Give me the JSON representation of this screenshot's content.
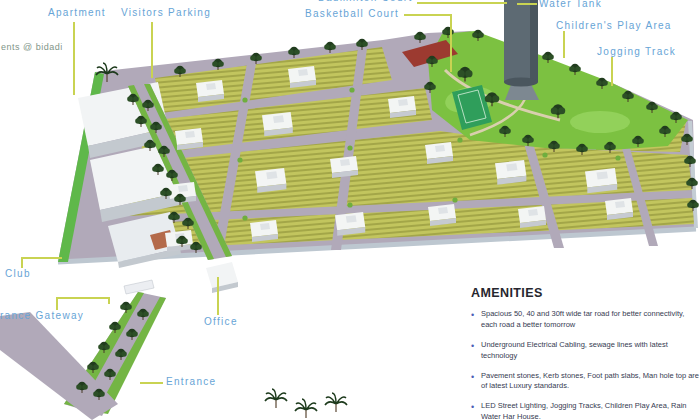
{
  "brand": {
    "text": "ents @ bidadi"
  },
  "map_labels": {
    "apartment": "Apartment",
    "visitors_parking": "Visitors Parking",
    "badminton_court": "Badminton Court",
    "basketball_court": "Basketball Court",
    "water_tank": "Water Tank",
    "childrens_play_area": "Children's Play Area",
    "jogging_track": "Jogging Track",
    "club": "Club",
    "entrance_gateway": "Entrance Gateway",
    "office": "Office",
    "entrance": "Entrance"
  },
  "amenities": {
    "title": "AMENITIES",
    "items": [
      "Spacious 50, 40 and 30ft wide tar road for better connectivity, each road a better tomorrow",
      "Underground Electrical Cabling, sewage lines with latest technology",
      "Pavement stones, Kerb stones, Foot path slabs,  Man hole top are of latest Luxury standards.",
      "LED Street Lighting, Jogging Tracks, Children Play Area, Rain Water Har House."
    ]
  },
  "colors": {
    "label_blue": "#67a4d6",
    "leader_yellow": "#c9d352",
    "plot_yellow": "#bcbf58",
    "road_mauve": "#b1a9b9",
    "park_green": "#7cc141",
    "wall_gray": "#bdc7d0",
    "amenities_text": "#363b52",
    "bullet_blue": "#4a5db5"
  }
}
